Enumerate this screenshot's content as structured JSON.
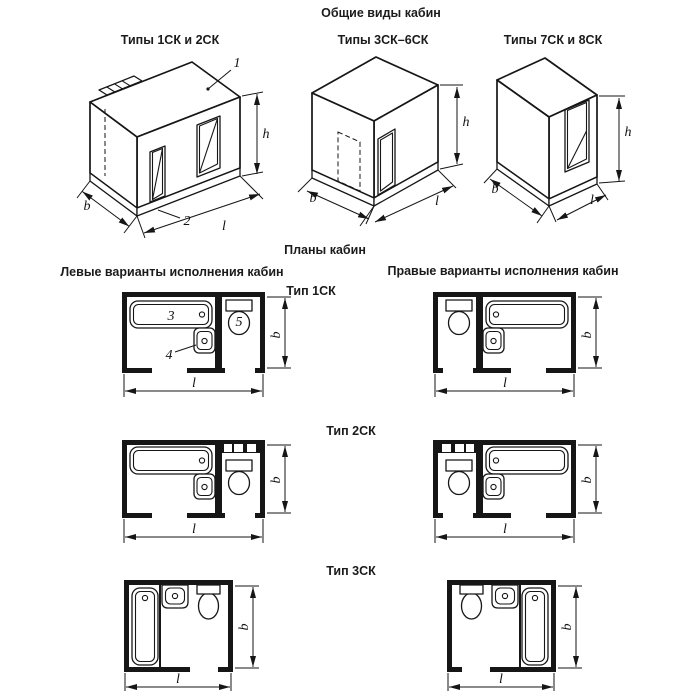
{
  "titles": {
    "main": "Общие виды кабин",
    "plans": "Планы кабин",
    "left_column": "Левые варианты исполнения кабин",
    "right_column": "Правые варианты исполнения кабин"
  },
  "views": [
    {
      "label": "Типы 1СК и 2СК"
    },
    {
      "label": "Типы 3СК–6СК"
    },
    {
      "label": "Типы 7СК и 8СК"
    }
  ],
  "plan_types": [
    {
      "label": "Тип 1СК"
    },
    {
      "label": "Тип 2СК"
    },
    {
      "label": "Тип 3СК"
    }
  ],
  "dimensions": {
    "width": "b",
    "length": "l",
    "height": "h"
  },
  "callouts": {
    "c1": "1",
    "c2": "2",
    "c3": "3",
    "c4": "4",
    "c5": "5"
  }
}
